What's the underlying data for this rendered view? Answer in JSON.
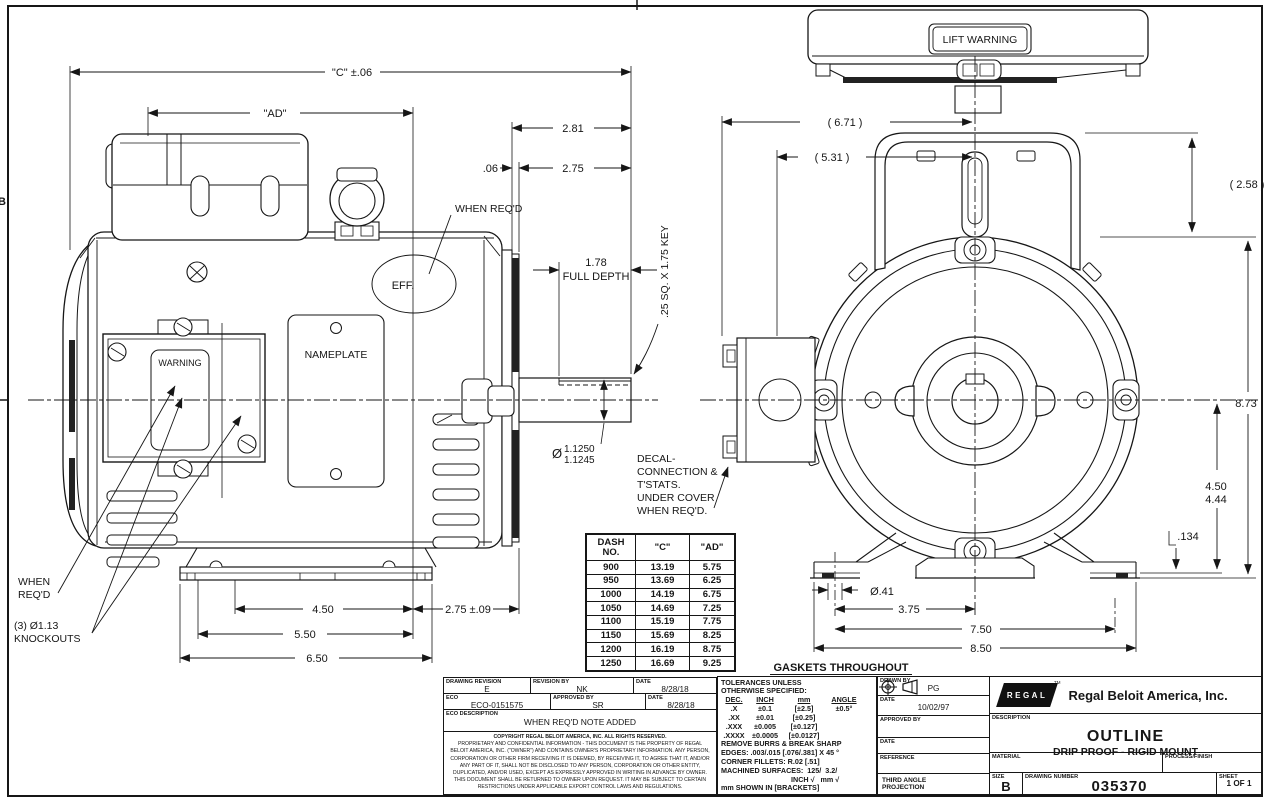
{
  "page": {
    "zone_marker": "B"
  },
  "gaskets_note": "GASKETS THROUGHOUT",
  "side_view": {
    "dim_c": "\"C\" ±.06",
    "dim_ad": "\"AD\"",
    "dim_2_81": "2.81",
    "dim_06": ".06",
    "dim_2_75": "2.75",
    "when_reqd": "WHEN REQ'D",
    "eff": "EFF.",
    "nameplate": "NAMEPLATE",
    "warning": "WARNING",
    "full_depth_val": "1.78",
    "full_depth_lbl": "FULL DEPTH",
    "key_note": ".25 SQ. X 1.75 KEY",
    "shaft_dia_sym": "Ø",
    "shaft_dia_hi": "1.1250",
    "shaft_dia_lo": "1.1245",
    "decal_l1": "DECAL-",
    "decal_l2": "CONNECTION &",
    "decal_l3": "T'STATS.",
    "decal_l4": "UNDER COVER",
    "decal_l5": "WHEN REQ'D.",
    "when_l1": "WHEN",
    "when_l2": "REQ'D",
    "ko_l1": "(3) Ø1.13",
    "ko_l2": "KNOCKOUTS",
    "dim_450": "4.50",
    "dim_550": "5.50",
    "dim_650": "6.50",
    "dim_275_09": "2.75 ±.09"
  },
  "front_view": {
    "lift_warning": "LIFT WARNING",
    "dim_671": "( 6.71 )",
    "dim_531": "( 5.31 )",
    "dim_258": "( 2.58 )",
    "dim_873": "8.73",
    "dim_450": "4.50",
    "dim_444": "4.44",
    "dim_134": ".134",
    "dim_o41": "Ø.41",
    "dim_375": "3.75",
    "dim_750": "7.50",
    "dim_850": "8.50"
  },
  "dim_table": {
    "col_dash_1": "DASH",
    "col_dash_2": "NO.",
    "col_c": "\"C\"",
    "col_ad": "\"AD\"",
    "rows": [
      {
        "dash": "900",
        "c": "13.19",
        "ad": "5.75"
      },
      {
        "dash": "950",
        "c": "13.69",
        "ad": "6.25"
      },
      {
        "dash": "1000",
        "c": "14.19",
        "ad": "6.75"
      },
      {
        "dash": "1050",
        "c": "14.69",
        "ad": "7.25"
      },
      {
        "dash": "1100",
        "c": "15.19",
        "ad": "7.75"
      },
      {
        "dash": "1150",
        "c": "15.69",
        "ad": "8.25"
      },
      {
        "dash": "1200",
        "c": "16.19",
        "ad": "8.75"
      },
      {
        "dash": "1250",
        "c": "16.69",
        "ad": "9.25"
      }
    ]
  },
  "rev_block": {
    "drawing_revision_label": "DRAWING REVISION",
    "drawing_revision": "E",
    "revision_by_label": "REVISION BY",
    "revision_by": "NK",
    "date1_label": "DATE",
    "date1": "8/28/18",
    "eco_label": "ECO",
    "eco": "ECO-0151575",
    "approved_label": "APPROVED BY",
    "approved": "SR",
    "date2_label": "DATE",
    "date2": "8/28/18",
    "eco_desc_label": "ECO DESCRIPTION",
    "eco_desc": "WHEN REQ'D NOTE ADDED",
    "copyright_title": "COPYRIGHT REGAL BELOIT AMERICA, INC. ALL RIGHTS RESERVED.",
    "copyright_body": "PROPRIETARY AND CONFIDENTIAL INFORMATION - THIS DOCUMENT IS THE PROPERTY OF REGAL BELOIT AMERICA, INC. (\"OWNER\") AND CONTAINS OWNER'S PROPRIETARY INFORMATION. ANY PERSON, CORPORATION OR OTHER FIRM RECEIVING IT IS DEEMED, BY RECEIVING IT, TO AGREE THAT IT, AND/OR ANY PART OF IT, SHALL NOT BE DISCLOSED TO ANY PERSON, CORPORATION OR OTHER ENTITY, DUPLICATED, AND/OR USED, EXCEPT AS EXPRESSLY APPROVED IN WRITING IN ADVANCE BY OWNER. THIS DOCUMENT SHALL BE RETURNED TO OWNER UPON REQUEST. IT MAY BE SUBJECT TO CERTAIN RESTRICTIONS UNDER APPLICABLE EXPORT CONTROL LAWS AND REGULATIONS."
  },
  "tol_block": {
    "title1": "TOLERANCES UNLESS",
    "title2": "OTHERWISE SPECIFIED:",
    "h_dec": "DEC.",
    "h_inch": "INCH",
    "h_mm": "mm",
    "h_angle": "ANGLE",
    "rows": [
      {
        "dec": ".X",
        "inch": "±0.1",
        "mm": "[±2.5]",
        "angle": "±0.5°"
      },
      {
        "dec": ".XX",
        "inch": "±0.01",
        "mm": "[±0.25]",
        "angle": ""
      },
      {
        "dec": ".XXX",
        "inch": "±0.005",
        "mm": "[±0.127]",
        "angle": ""
      },
      {
        "dec": ".XXXX",
        "inch": "±0.0005",
        "mm": "[±0.0127]",
        "angle": ""
      }
    ],
    "note1": "REMOVE BURRS & BREAK SHARP",
    "note2": "EDGES: .003/.015 [.076/.381] X 45 °",
    "note3": "CORNER FILLETS: R.02 [.51]",
    "mach_l1": "MACHINED SURFACES:  125/  3.2/",
    "mach_l2": "INCH √   mm √",
    "note5": "mm SHOWN IN [BRACKETS]"
  },
  "title_block": {
    "drawn_by_label": "DRAWN BY",
    "drawn_by": "PG",
    "date1_label": "DATE",
    "date1": "10/02/97",
    "approved_label": "APPROVED BY",
    "approved": "",
    "date2_label": "DATE",
    "date2": "",
    "reference_label": "REFERENCE",
    "reference": "",
    "projection_label1": "THIRD ANGLE",
    "projection_label2": "PROJECTION",
    "logo_text": "REGAL",
    "tm": "TM",
    "company": "Regal Beloit America, Inc.",
    "description_label": "DESCRIPTION",
    "description_line1": "OUTLINE",
    "description_line2": "DRIP PROOF - RIGID MOUNT",
    "material_label": "MATERIAL",
    "material": "",
    "process_label": "PROCESS/FINISH",
    "process": "",
    "size_label": "SIZE",
    "size": "B",
    "drawing_number_label": "DRAWING NUMBER",
    "drawing_number": "035370",
    "sheet_label": "SHEET",
    "sheet": "1 OF 1"
  }
}
